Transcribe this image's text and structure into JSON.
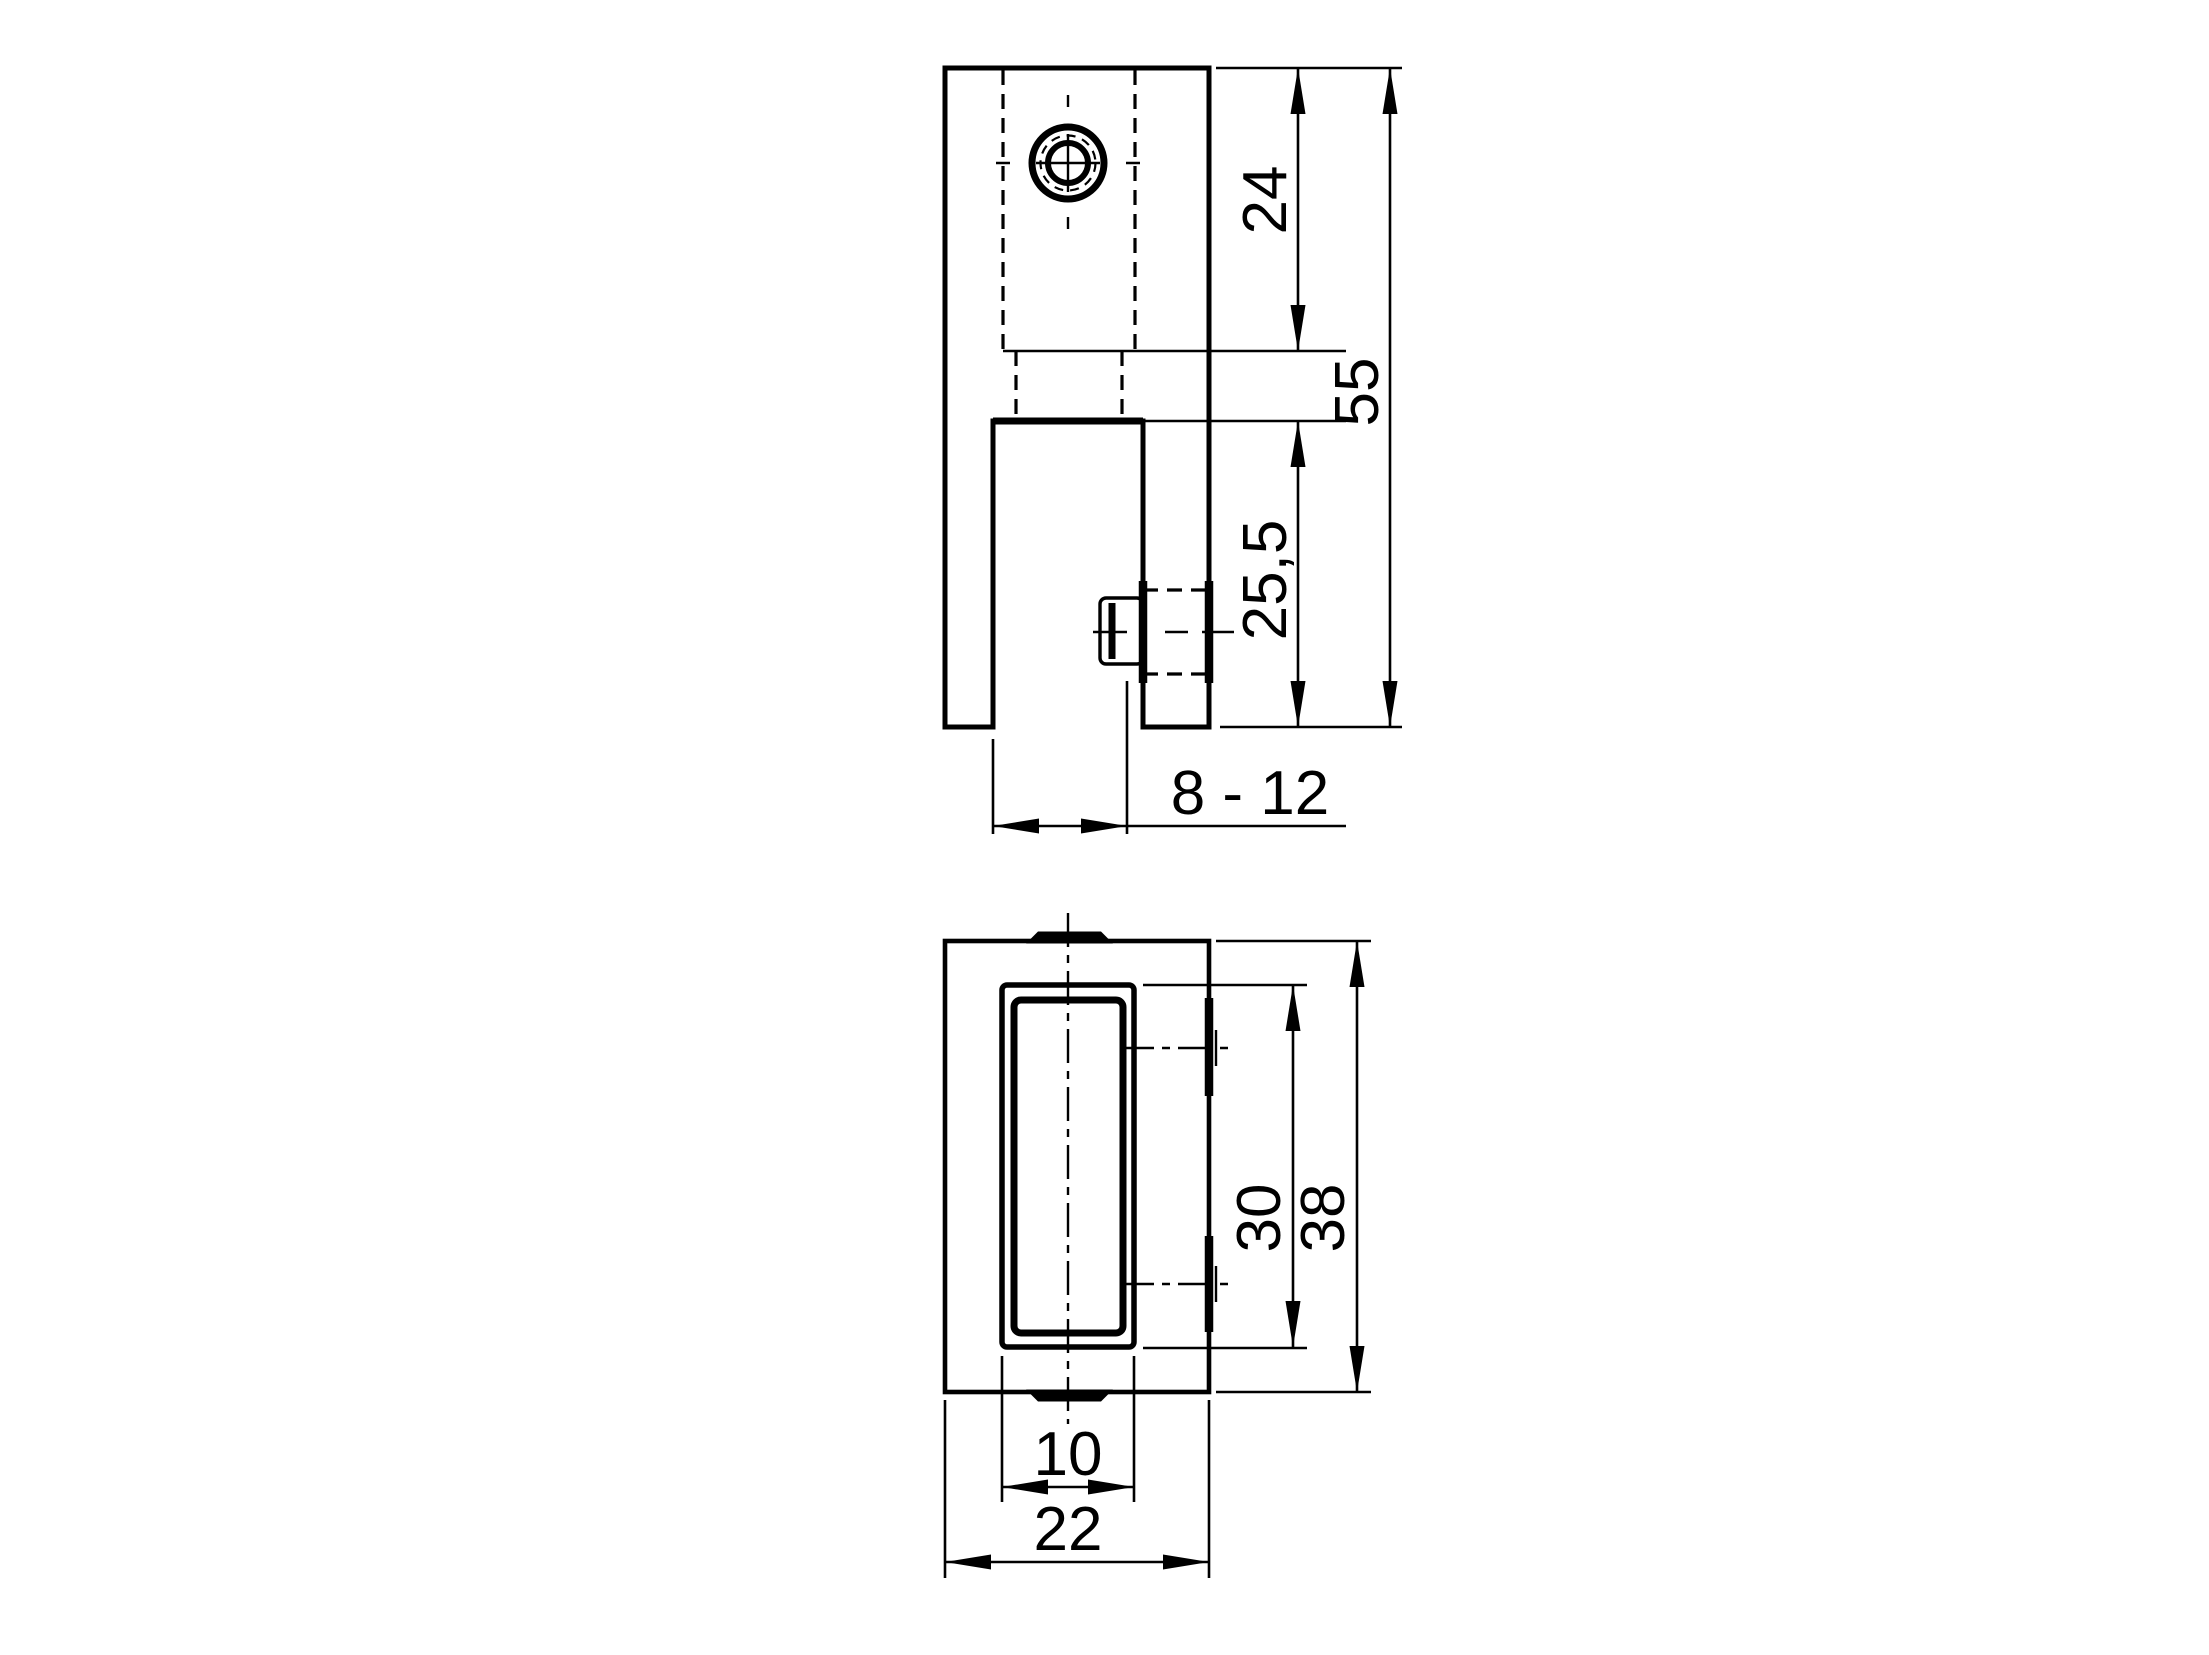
{
  "figure": {
    "type": "technical-drawing",
    "background_color": "#ffffff",
    "line_color": "#000000",
    "views": {
      "side_view": {
        "dims": {
          "hole_section_height": "24",
          "total_height": "55",
          "slot_depth": "25,5",
          "clamping_range": "8 - 12"
        }
      },
      "bottom_view": {
        "dims": {
          "slot_length": "30",
          "body_length": "38",
          "slot_width": "10",
          "body_width": "22"
        }
      }
    }
  }
}
